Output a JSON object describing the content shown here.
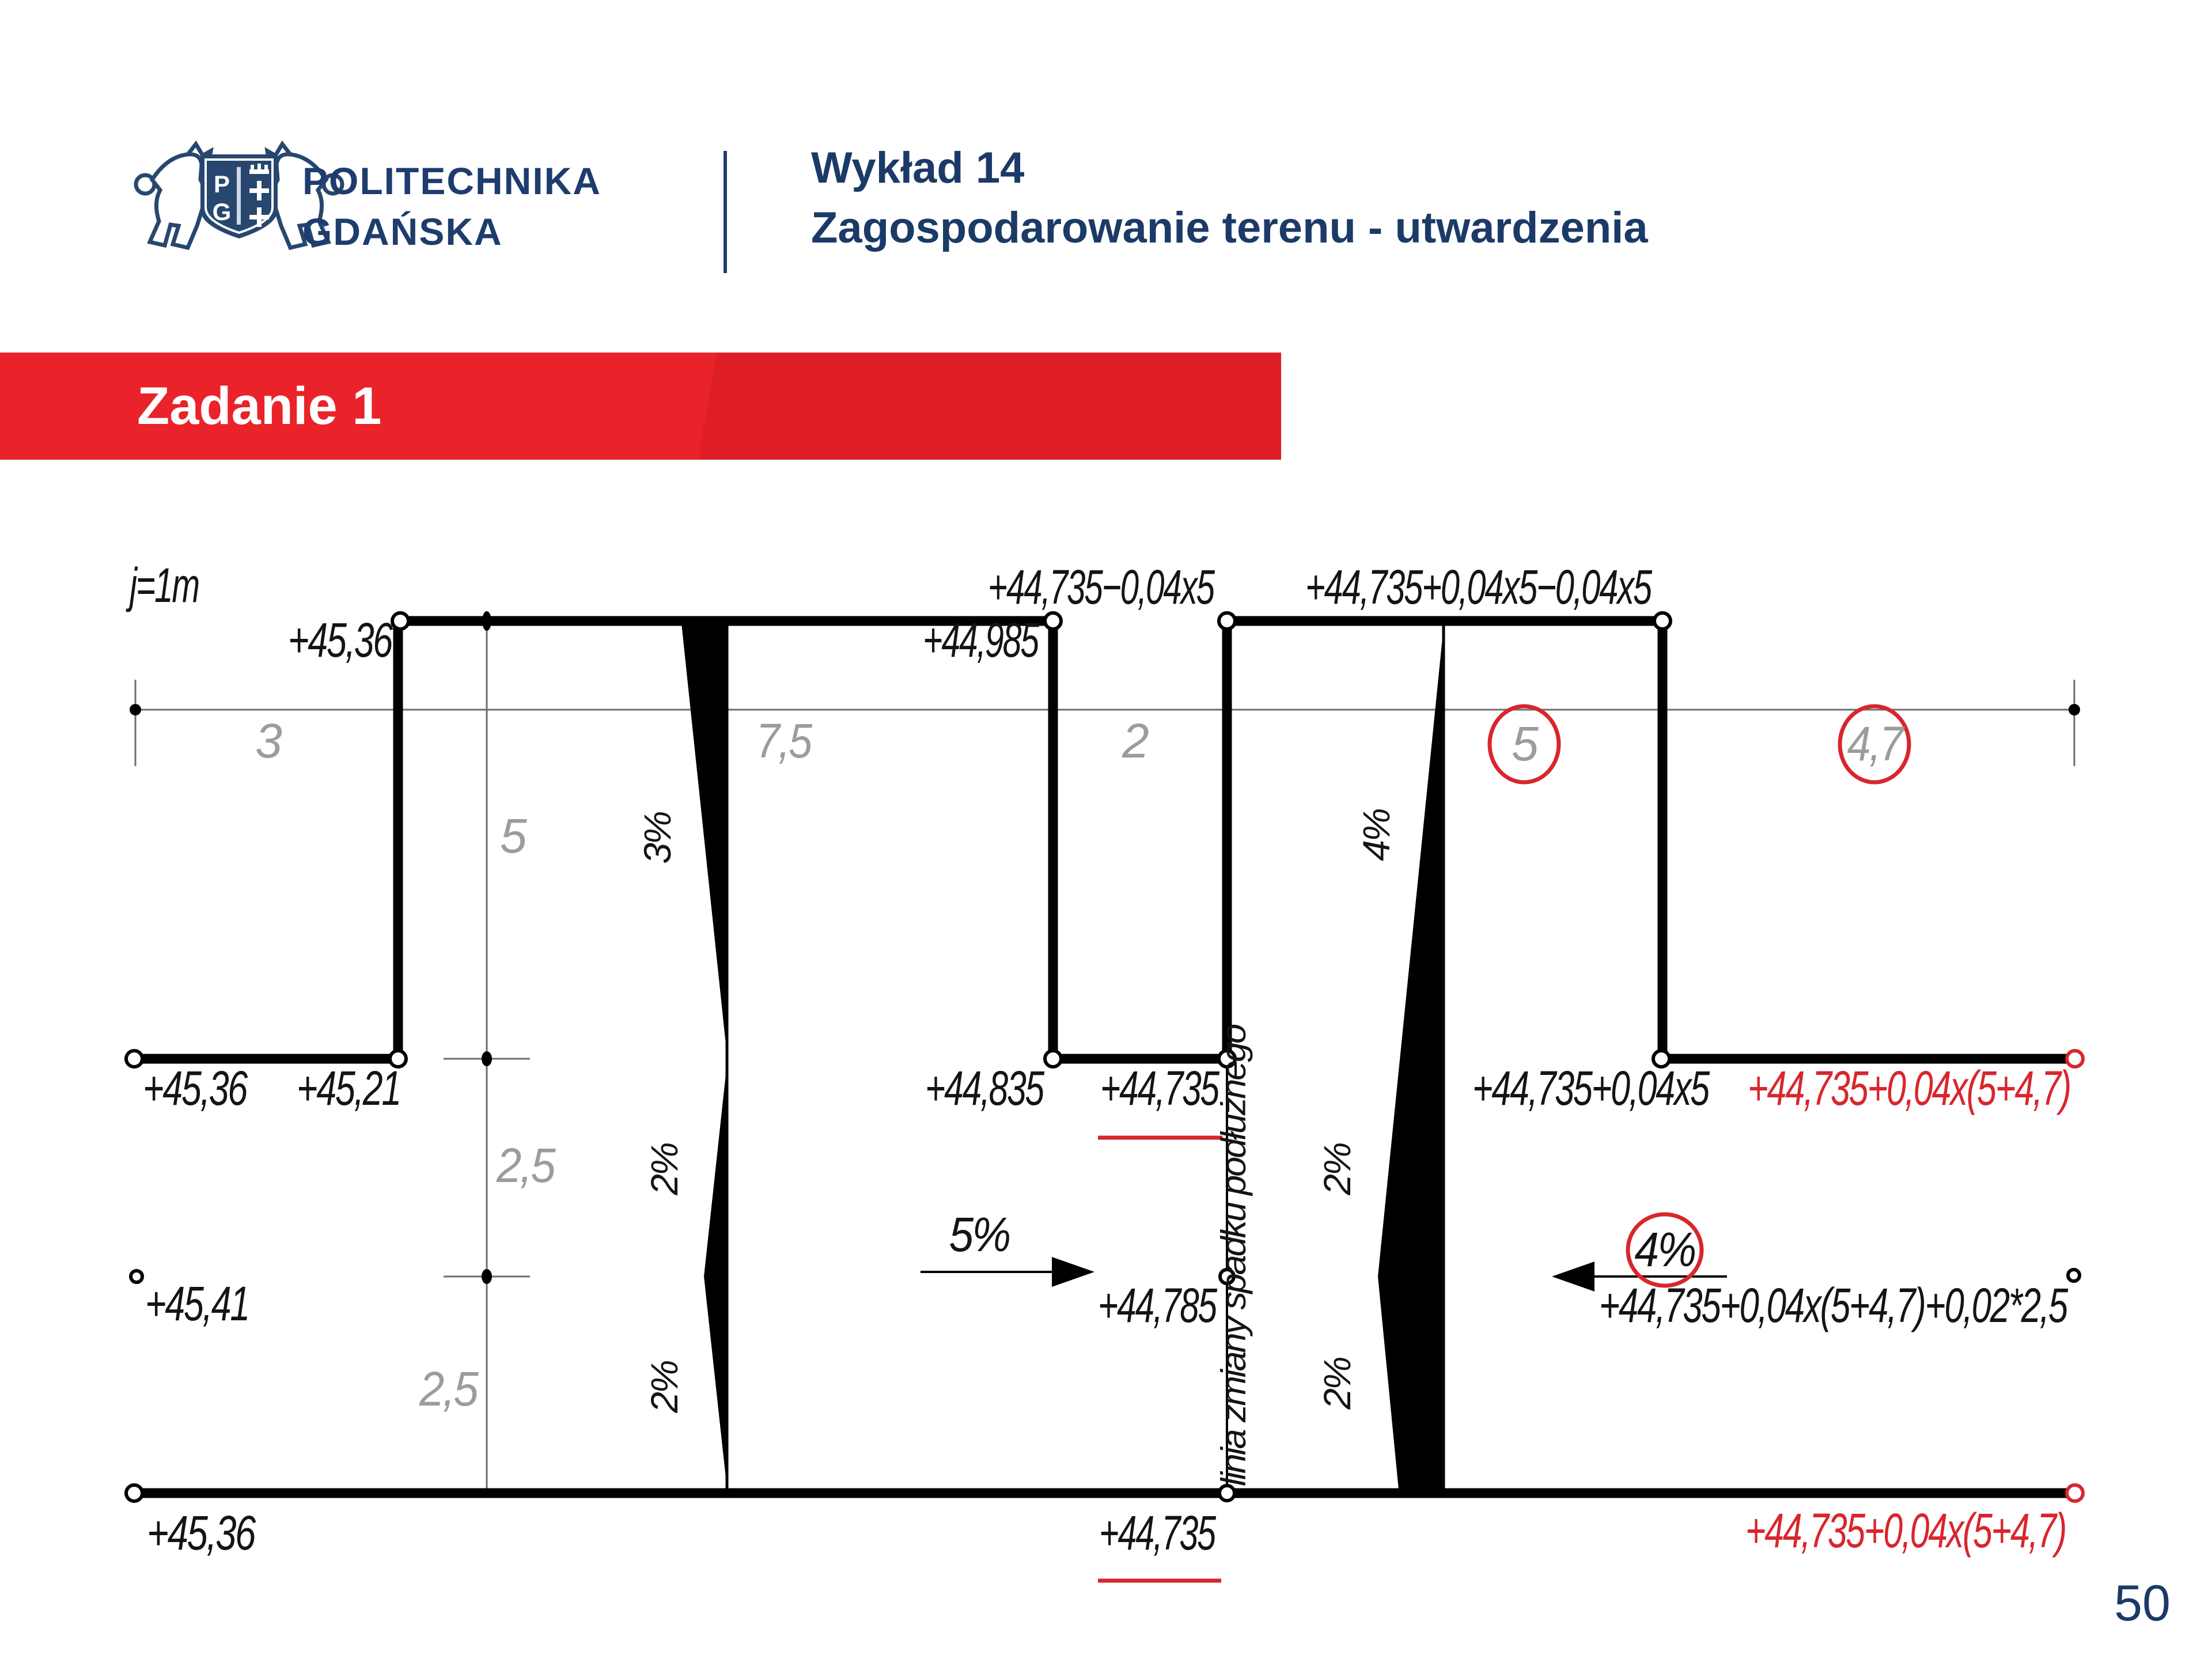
{
  "header": {
    "brand_line1": "POLITECHNIKA",
    "brand_line2": "GDAŃSKA",
    "logo_monogram_left": "P",
    "logo_monogram_right": "G",
    "lecture_title": "Wykład 14",
    "lecture_subtitle": "Zagospodarowanie terenu - utwardzenia"
  },
  "banner": {
    "label": "Zadanie 1"
  },
  "footer": {
    "page_number": "50"
  },
  "colors": {
    "navy": "#1e3c6d",
    "banner_red": "#e92329",
    "annotation_red": "#d8262c",
    "dim_gray": "#9c9c9c"
  },
  "diagram": {
    "scale_note": "j=1m",
    "top": {
      "elev_left": "+45,36",
      "elev_mid": "+44,985",
      "formula_left": "+44,735−0,04x5",
      "formula_right": "+44,735+0,04x5−0,04x5"
    },
    "dims": {
      "h1": "3",
      "h2": "7,5",
      "h3": "2",
      "h4_circled": "5",
      "h5_circled": "4,7",
      "v1": "5",
      "v2": "2,5",
      "v3": "2,5"
    },
    "row_mid": {
      "e1": "+45,36",
      "e2": "+45,21",
      "e3": "+44,835",
      "e4": "+44,735",
      "e5": "+44,735+0,04x5",
      "e6_red": "+44,735+0,04x(5+4,7)"
    },
    "slopes": {
      "left_top": "3%",
      "left_mid": "2%",
      "left_bot": "2%",
      "right_top": "4%",
      "right_mid": "2%",
      "right_bot": "2%"
    },
    "center": {
      "elev_left": "+45,41",
      "pct_left": "5%",
      "elev_mid": "+44,785",
      "pct_right": "4%",
      "formula": "+44,735+0,04x(5+4,7)+0,02*2,5"
    },
    "bottom": {
      "e1": "+45,36",
      "e2": "+44,735",
      "e3_red": "+44,735+0,04x(5+4,7)"
    },
    "slope_change_label": "linia zmiany spadku podłużnego"
  }
}
